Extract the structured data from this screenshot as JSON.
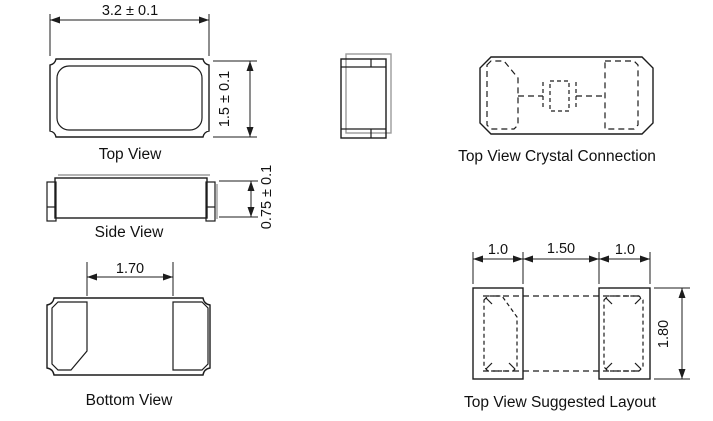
{
  "page": {
    "background": "#ffffff",
    "line_color": "#1c1c1c",
    "shadow_color": "#9b9b9b"
  },
  "views": {
    "top_view": {
      "label": "Top View",
      "width_dim": "3.2 ± 0.1",
      "height_dim": "1.5 ± 0.1"
    },
    "side_view": {
      "label": "Side View",
      "height_dim": "0.75 ± 0.1"
    },
    "bottom_view": {
      "label": "Bottom View",
      "pad_gap_dim": "1.70"
    },
    "crystal_connection": {
      "label": "Top View Crystal Connection"
    },
    "suggested_layout": {
      "label": "Top View Suggested Layout",
      "left_pad_width_dim": "1.0",
      "pad_gap_dim": "1.50",
      "right_pad_width_dim": "1.0",
      "height_dim": "1.80"
    }
  }
}
